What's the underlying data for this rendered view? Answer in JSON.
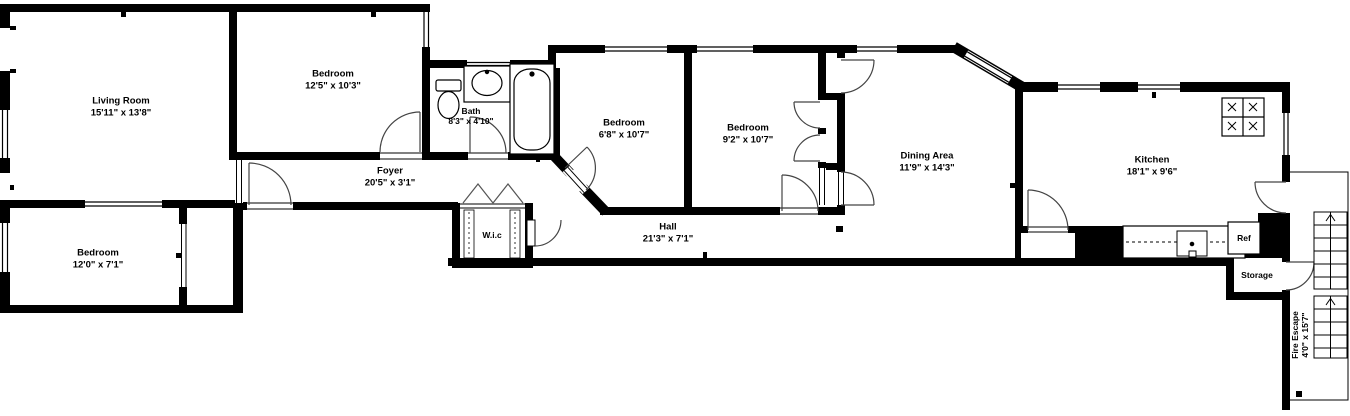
{
  "title": "Apartment floor plan",
  "colors": {
    "wall": "#000000",
    "floor": "#ffffff"
  },
  "rooms": {
    "living_room": {
      "name": "Living Room",
      "dims": "15'11\" x 13'8\""
    },
    "bedroom_top": {
      "name": "Bedroom",
      "dims": "12'5\" x 10'3\""
    },
    "bath": {
      "name": "Bath",
      "dims": "8'3\" x 4'10\""
    },
    "bedroom_mid_left": {
      "name": "Bedroom",
      "dims": "6'8\" x 10'7\""
    },
    "bedroom_mid_right": {
      "name": "Bedroom",
      "dims": "9'2\" x 10'7\""
    },
    "dining_area": {
      "name": "Dining Area",
      "dims": "11'9\" x 14'3\""
    },
    "kitchen": {
      "name": "Kitchen",
      "dims": "18'1\" x 9'6\""
    },
    "foyer": {
      "name": "Foyer",
      "dims": "20'5\" x 3'1\""
    },
    "hall": {
      "name": "Hall",
      "dims": "21'3\" x 7'1\""
    },
    "bedroom_bottom": {
      "name": "Bedroom",
      "dims": "12'0\" x 7'1\""
    },
    "wic": {
      "name": "W.i.c"
    },
    "storage": {
      "name": "Storage"
    },
    "fire_escape": {
      "name": "Fire Escape",
      "dims": "4'0\" x 15'7\""
    }
  },
  "fixtures": {
    "fridge_label": "Ref"
  }
}
